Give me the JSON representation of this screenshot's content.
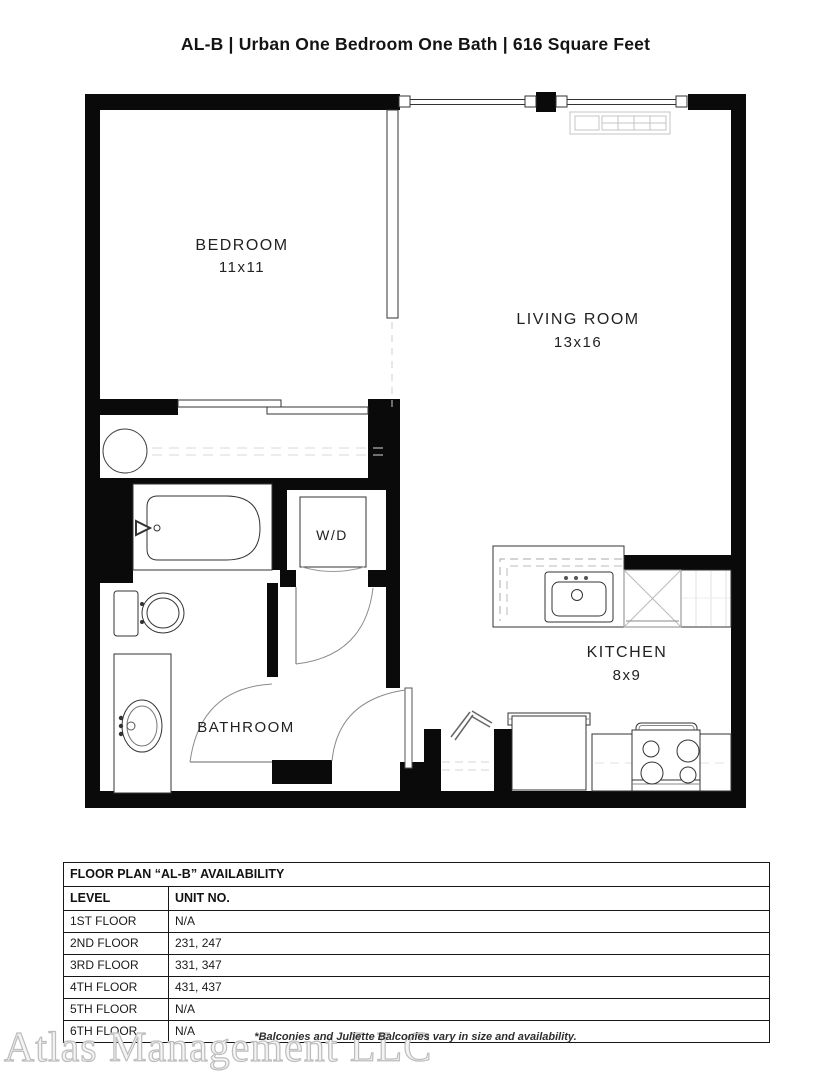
{
  "title": "AL-B | Urban One Bedroom One Bath | 616 Square Feet",
  "floor_plan": {
    "labels": {
      "bedroom": "BEDROOM",
      "bedroom_dims": "11x11",
      "living_room": "LIVING ROOM",
      "living_room_dims": "13x16",
      "kitchen": "KITCHEN",
      "kitchen_dims": "8x9",
      "bathroom": "BATHROOM",
      "washer_dryer": "W/D"
    },
    "colors": {
      "wall": "#0a0a0a",
      "fixture_line": "#3d3d3d",
      "light_line": "#c4c4c4"
    }
  },
  "availability_table": {
    "title": "FLOOR PLAN “AL-B” AVAILABILITY",
    "columns": [
      "LEVEL",
      "UNIT NO."
    ],
    "rows": [
      {
        "level": "1ST FLOOR",
        "units": "N/A"
      },
      {
        "level": "2ND FLOOR",
        "units": "231, 247"
      },
      {
        "level": "3RD FLOOR",
        "units": "331, 347"
      },
      {
        "level": "4TH FLOOR",
        "units": "431, 437"
      },
      {
        "level": "5TH FLOOR",
        "units": "N/A"
      },
      {
        "level": "6TH FLOOR",
        "units": "N/A"
      }
    ]
  },
  "footnote": "*Balconies and Juliette Balconies vary in size and availability.",
  "watermark": "Atlas Management LLC"
}
